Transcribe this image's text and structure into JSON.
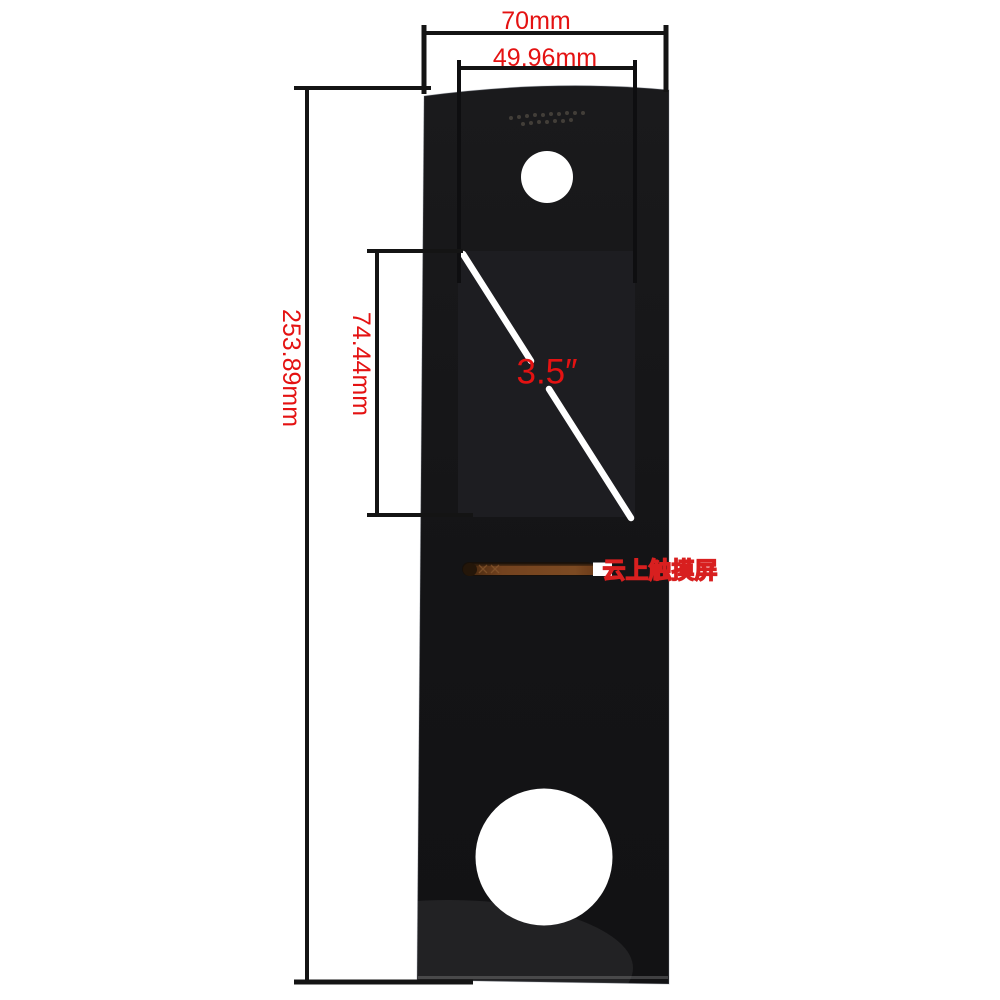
{
  "meta": {
    "description": "Dimensional product photo of a 3.5 inch black glass front panel (touch screen cover glass) with camera hole, speaker grille, flex-cable slot and round lower cutout"
  },
  "labels": {
    "outer_width": "70mm",
    "display_width": "49.96mm",
    "outer_height": "253.89mm",
    "display_height": "74.44mm",
    "diagonal": "3.5″"
  },
  "watermark": {
    "text": "云上触摸屏"
  },
  "colors": {
    "background": "#ffffff",
    "annotation_red": "#e41212",
    "dimension_line_black": "#141414",
    "panel_black": "#17171a",
    "display_black": "#1d1d21",
    "slot_copper": "#7a4622",
    "diagonal_line_white": "#ffffff"
  }
}
